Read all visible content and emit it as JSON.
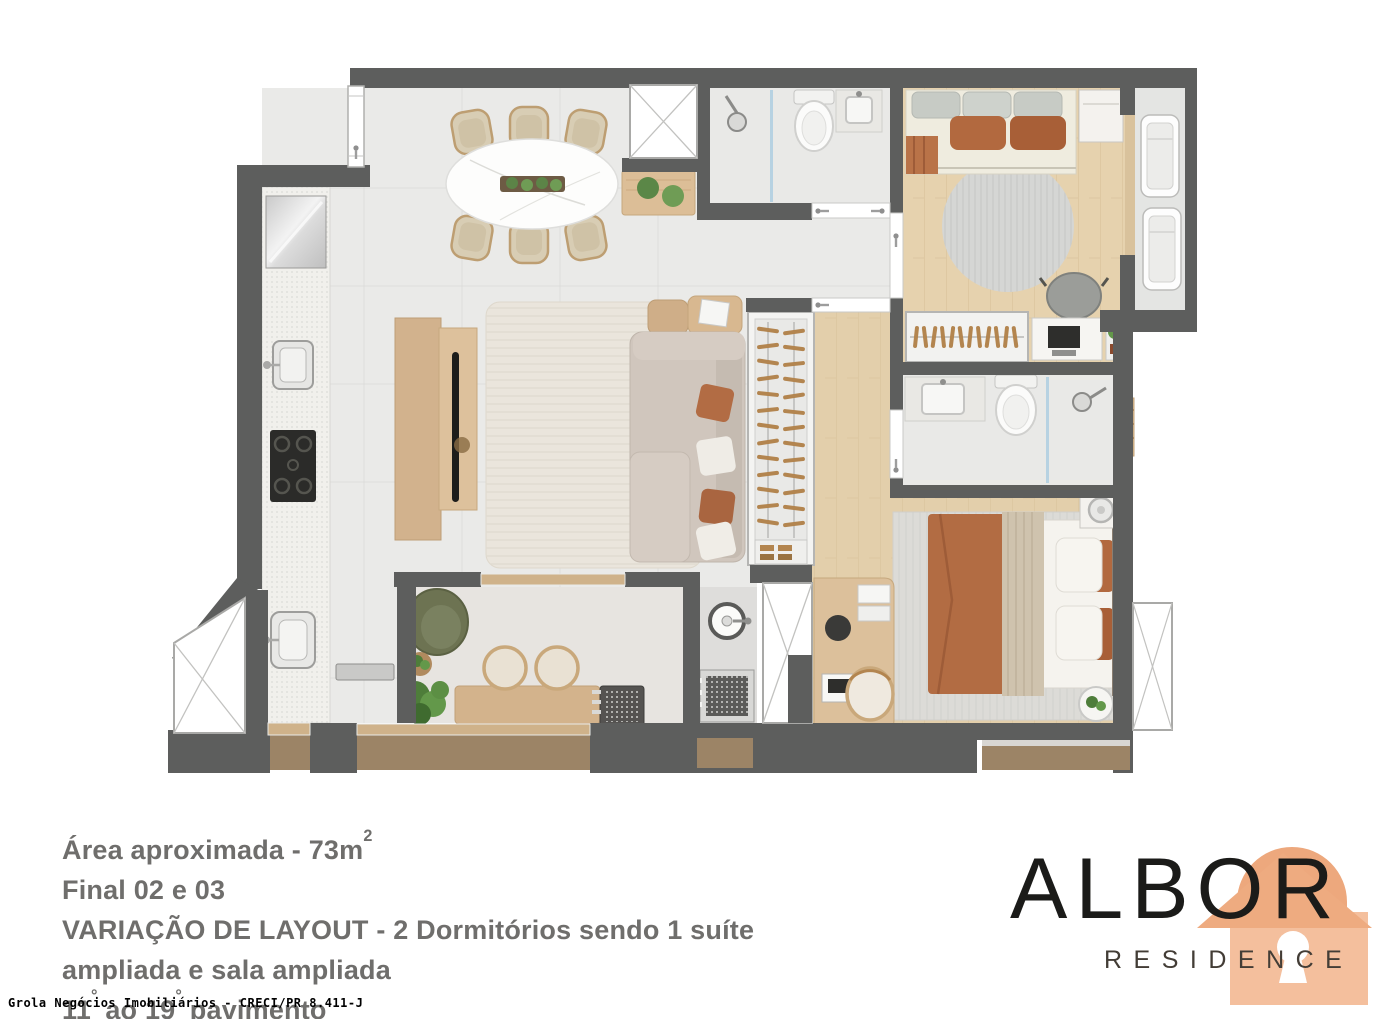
{
  "plan": {
    "colors": {
      "wall": "#5d5e5d",
      "tile_floor": "#eaeae8",
      "wood_floor": "#e6d2ae",
      "balcony_floor": "#9c8466",
      "logo_orange": "#efa87d"
    }
  },
  "caption": {
    "area_text": "Área aproximada - 73m",
    "area_sup": "2",
    "final_text": "Final 02 e 03",
    "layout_text": "VARIAÇÃO DE LAYOUT - 2 Dormitórios sendo 1 suíte ampliada e sala ampliada",
    "floors_n1": "11",
    "floors_deg1": "°",
    "floors_mid": " ao 19",
    "floors_deg2": "°",
    "floors_end": " pavimento"
  },
  "logo": {
    "title": "ALBOR",
    "tagline": "RESIDENCE"
  },
  "footer": {
    "credit": "Grola Negócios Imobiliários - CRECI/PR 8.411-J"
  }
}
